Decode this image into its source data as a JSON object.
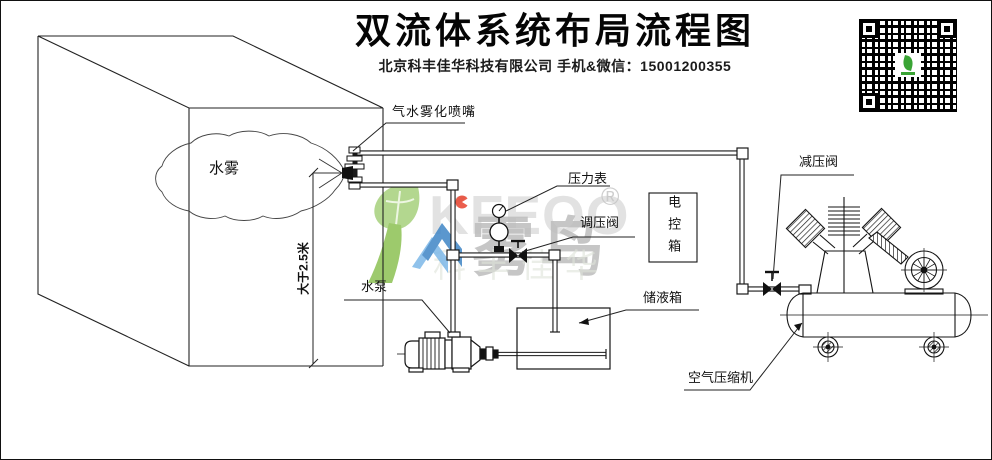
{
  "header": {
    "title": "双流体系统布局流程图",
    "subtitle": "北京科丰佳华科技有限公司 手机&微信：15001200355"
  },
  "labels": {
    "mist": "水雾",
    "nozzle": "气水雾化喷嘴",
    "pressure_gauge": "压力表",
    "regulating_valve": "调压阀",
    "control_box": "电控箱",
    "reducing_valve": "减压阀",
    "water_pump": "水泵",
    "storage_tank": "储液箱",
    "air_compressor": "空气压缩机",
    "height_dimension": "大于2.5米"
  },
  "watermark": {
    "latin": "KFEOO",
    "brand": "雾鸟",
    "company": "科丰佳华",
    "registered": "®"
  },
  "colors": {
    "line": "#1a1a1a",
    "watermark_green": "#8dc63f",
    "watermark_blue": "#4a8fd0",
    "watermark_gray": "#c4c4c4",
    "watermark_red": "#e8432e"
  }
}
